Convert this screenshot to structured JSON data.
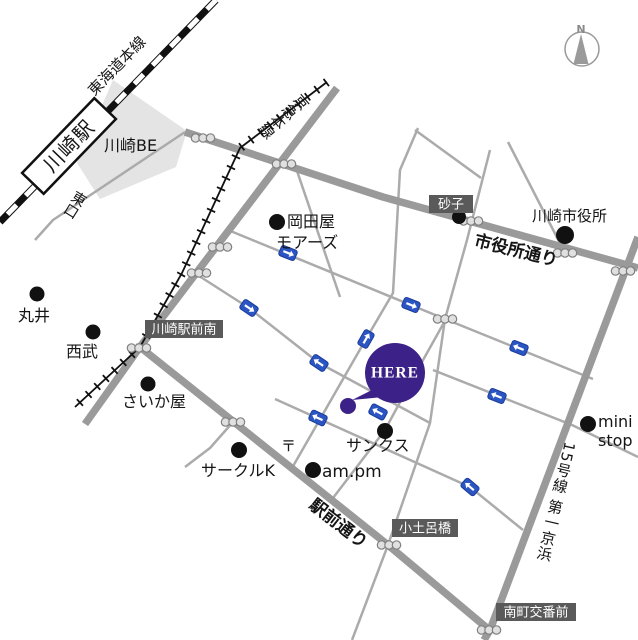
{
  "map": {
    "station": "川崎駅",
    "railways": {
      "tokaido": "東海道本線",
      "keikyu": "京急本線"
    },
    "streets": {
      "shiyakusho_dori": "市役所通り",
      "ekimae_dori": "駅前通り",
      "route15": "15号線 第一京浜"
    },
    "exits": {
      "east": "東口"
    },
    "badges": {
      "sunago": "砂子",
      "ekimae_minami": "川崎駅前南",
      "kodorobashi": "小土呂橋",
      "minamicho_kobanmae": "南町交番前"
    },
    "landmarks": {
      "kawasaki_be": "川崎BE",
      "okadaya_line1": "岡田屋",
      "okadaya_line2": "モアーズ",
      "marui": "丸井",
      "seibu": "西武",
      "saikaya": "さいか屋",
      "circle_k": "サークルK",
      "post_mark": "〒",
      "am_pm": "am.pm",
      "sunkus": "サンクス",
      "city_hall": "川崎市役所",
      "ministop_line1": "mini",
      "ministop_line2": "stop"
    },
    "marker": {
      "label": "HERE"
    },
    "compass": {
      "north": "N"
    },
    "colors": {
      "here_purple": "#3b2188",
      "oneway_blue": "#2b55c2",
      "road_thick": "#9a9a9a",
      "road_thin": "#ababab",
      "badge_bg": "#5a5a5a",
      "building_fill": "#e4e4e4",
      "railway_black": "#111111"
    },
    "symbols": {
      "signals": [
        [
          203,
          138
        ],
        [
          284,
          164
        ],
        [
          220,
          247
        ],
        [
          199,
          273
        ],
        [
          139,
          348
        ],
        [
          445,
          319
        ],
        [
          471,
          221
        ],
        [
          565,
          253
        ],
        [
          623,
          271
        ],
        [
          233,
          422
        ],
        [
          389,
          545
        ],
        [
          489,
          630
        ]
      ],
      "oneway_arrows": [
        {
          "x": 288,
          "y": 253,
          "rot": 22,
          "dir": 1
        },
        {
          "x": 249,
          "y": 308,
          "rot": 34,
          "dir": 1
        },
        {
          "x": 319,
          "y": 363,
          "rot": 34,
          "dir": -1
        },
        {
          "x": 411,
          "y": 305,
          "rot": 22,
          "dir": 1
        },
        {
          "x": 519,
          "y": 348,
          "rot": 22,
          "dir": -1
        },
        {
          "x": 497,
          "y": 396,
          "rot": 22,
          "dir": -1
        },
        {
          "x": 366,
          "y": 339,
          "rot": -60,
          "dir": 1
        },
        {
          "x": 318,
          "y": 418,
          "rot": 25,
          "dir": -1
        },
        {
          "x": 378,
          "y": 412,
          "rot": 28,
          "dir": -1
        },
        {
          "x": 470,
          "y": 487,
          "rot": 40,
          "dir": -1
        }
      ]
    }
  }
}
